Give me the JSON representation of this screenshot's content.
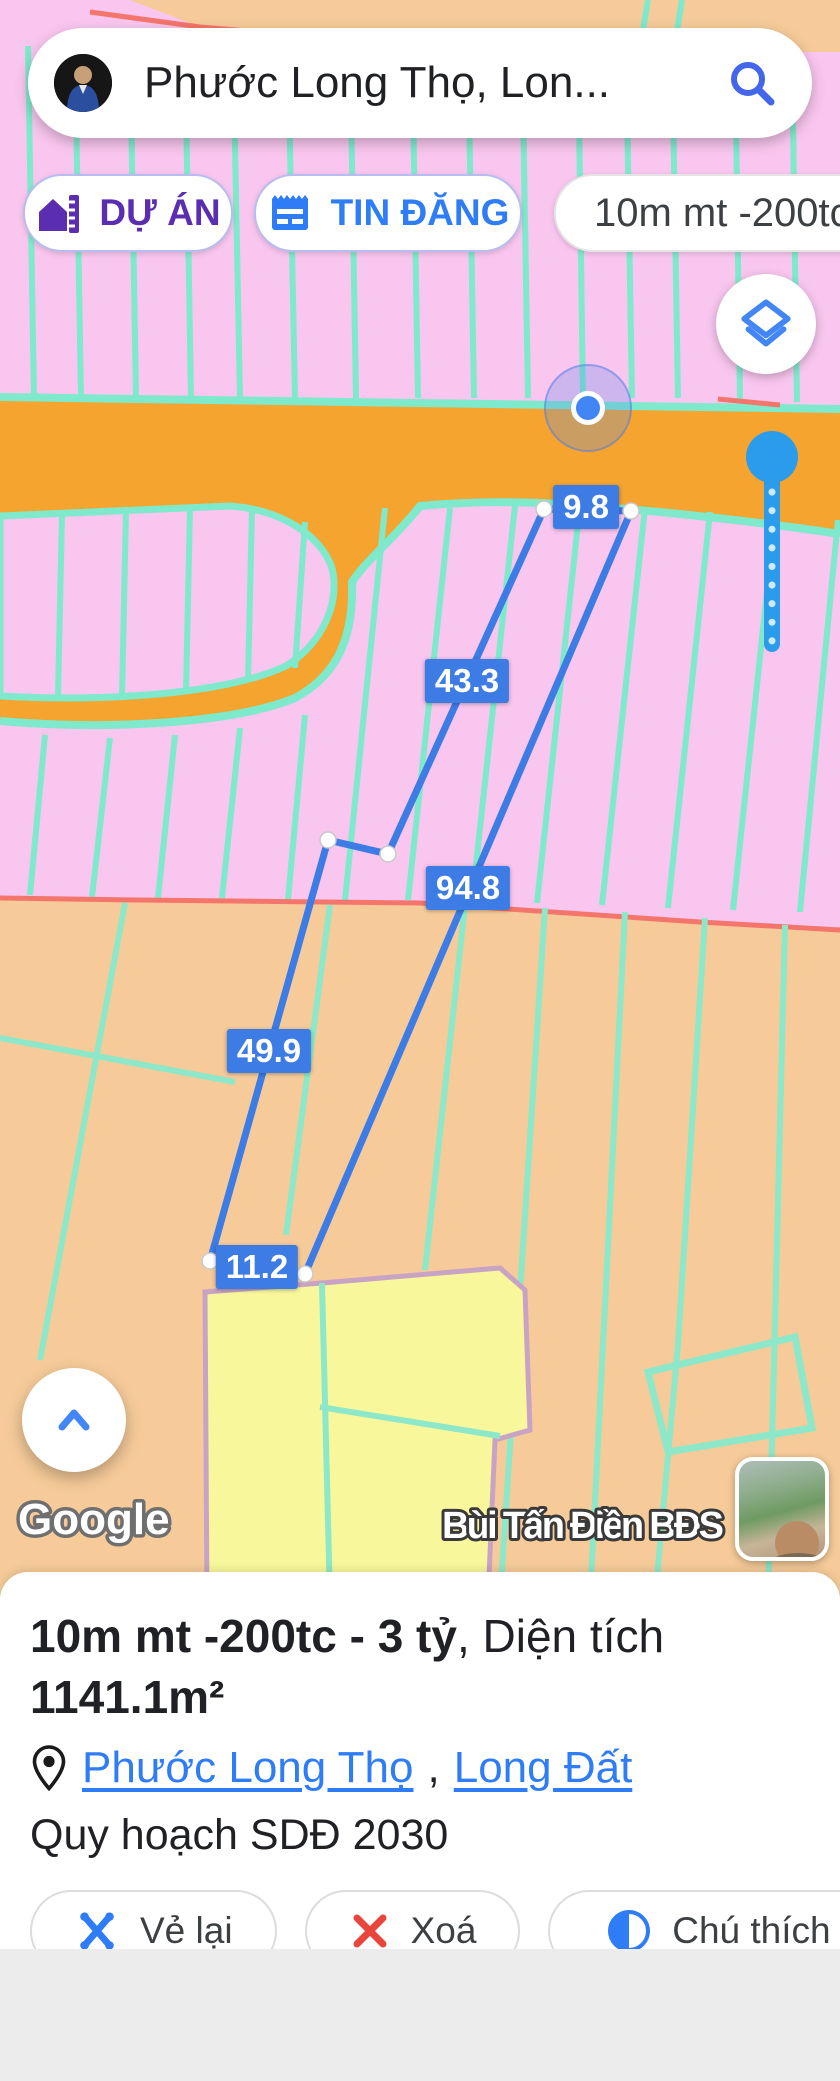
{
  "search_bar": {
    "query": "Phước Long Thọ, Lon..."
  },
  "chips": [
    {
      "id": "duan",
      "label": "DỰ ÁN"
    },
    {
      "id": "tindang",
      "label": "TIN ĐĂNG"
    },
    {
      "id": "info",
      "label": "10m mt -200tc - 3"
    }
  ],
  "map": {
    "measurements": {
      "top": "9.8",
      "upper_left": "43.3",
      "right": "94.8",
      "lower_left": "49.9",
      "bottom": "11.2"
    },
    "google_logo": "Google",
    "brand_watermark": "Bùi Tấn Điền BĐS"
  },
  "panel": {
    "title_bold1": "10m mt -200tc - 3 tỷ",
    "title_regular": ", Diện tích ",
    "title_bold2": "1141.1m²",
    "location": {
      "link1": "Phước Long Thọ",
      "separator": ", ",
      "link2": "Long Đất"
    },
    "plan": "Quy hoạch SDĐ 2030",
    "buttons": {
      "redraw": "Vẻ lại",
      "delete": "Xoá",
      "legend": "Chú thích"
    }
  },
  "colors": {
    "measure_blue": "#3D7BE5",
    "link_blue": "#2E7CF6",
    "chip_purple": "#5B2DB0",
    "slider_blue": "#2B9CEB",
    "road_orange": "#F5A42F",
    "parcel_pink": "#F9C6EF",
    "parcel_peach": "#F6CB99",
    "parcel_yellow": "#F8F79B",
    "line_teal": "#7FE9CC",
    "boundary_red": "#F4756B"
  }
}
